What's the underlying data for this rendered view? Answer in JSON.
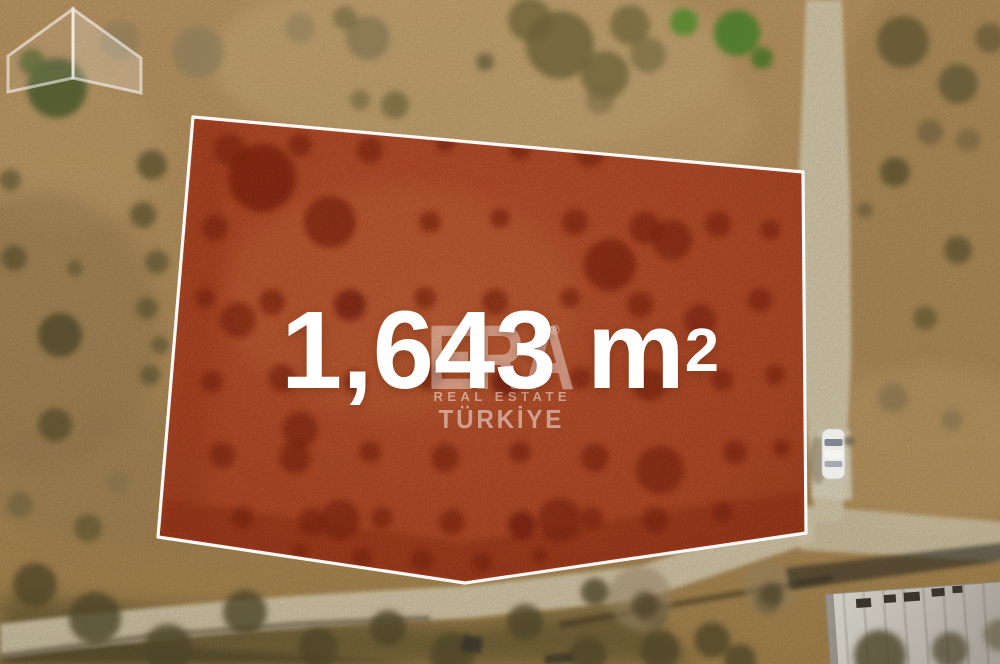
{
  "photo": {
    "description": "Aerial drone photo of a rural land parcel outlined for sale",
    "parcel": {
      "area_value": "1,643 m",
      "area_superscript": "2"
    },
    "watermark": {
      "icon": "era-house-icon",
      "brand": "ERA",
      "registered_mark": "®",
      "tagline": "REAL ESTATE",
      "country": "TÜRKİYE"
    },
    "colors": {
      "parcel_overlay": "#c1512d",
      "parcel_tree": "#8c2712",
      "parcel_border": "#ffffff",
      "terrain": "#b8945f",
      "road": "#dbd0b2",
      "area_text": "#ffffff"
    }
  }
}
